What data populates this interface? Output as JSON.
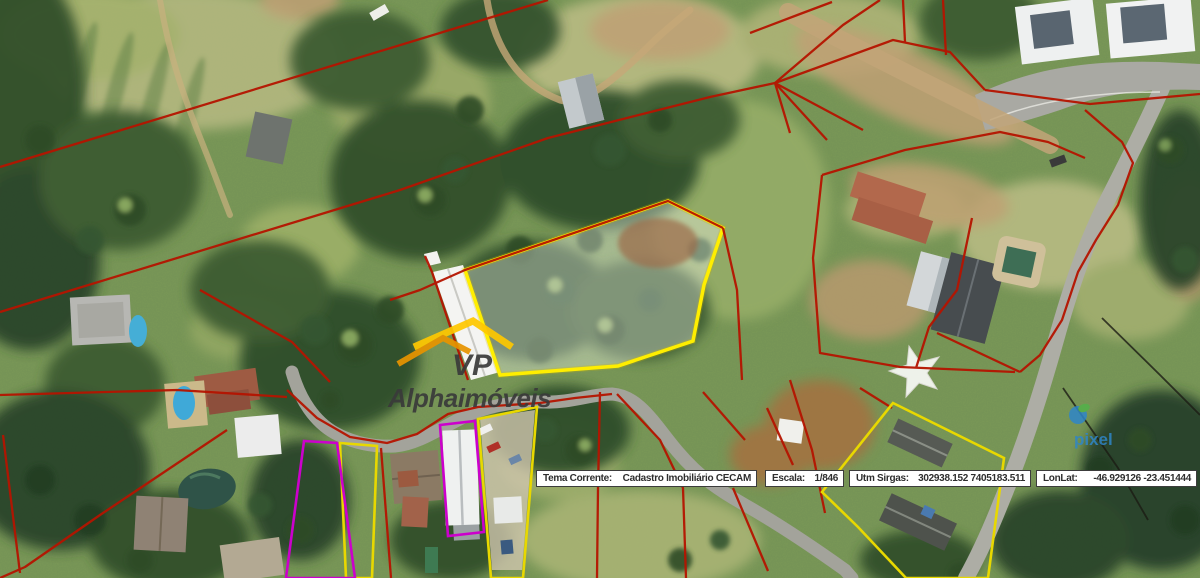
{
  "status_bar": {
    "fields": [
      {
        "id": "tema",
        "label": "Tema Corrente:",
        "value": "Cadastro Imobiliário CECAM"
      },
      {
        "id": "escala",
        "label": "Escala:",
        "value": "1/846"
      },
      {
        "id": "utm",
        "label": "Utm Sirgas:",
        "value": "302938.152 7405183.511"
      },
      {
        "id": "lonlat",
        "label": "LonLat:",
        "value": "-46.929126 -23.451444"
      }
    ]
  },
  "watermarks": {
    "vp_logo": {
      "line1": "VP",
      "line2": "Alphaimóveis"
    },
    "pixel_logo": {
      "text": "pixel"
    }
  },
  "colors": {
    "cadastre_line": "#b51400",
    "highlight_parcel": "#ffee00",
    "secondary_parcel": "#e8d800",
    "tertiary_parcel": "#cc00cc",
    "vp_roof_yellow": "#ffc800",
    "vp_roof_orange": "#e89400",
    "vp_text": "#3a3a3a",
    "pixel_blue": "#2f86c8"
  }
}
